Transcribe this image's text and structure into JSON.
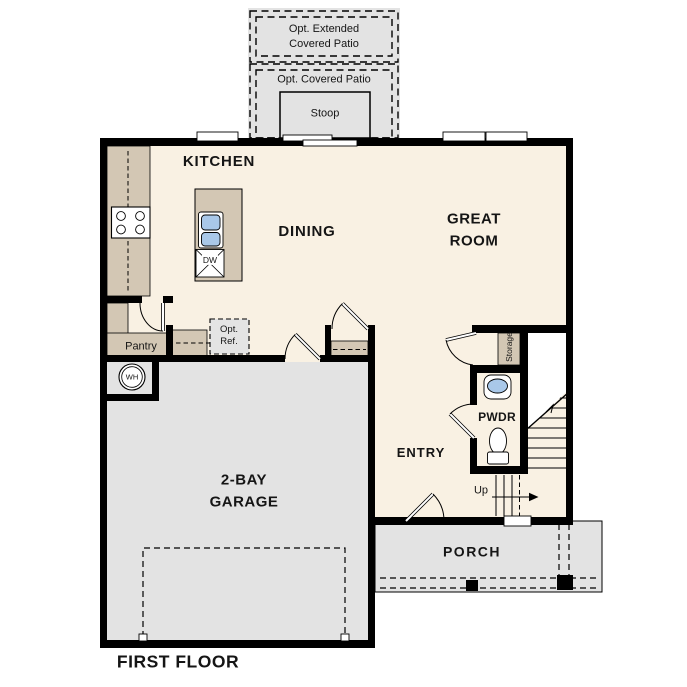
{
  "title": "FIRST FLOOR",
  "rooms": {
    "kitchen": "KITCHEN",
    "dining": "DINING",
    "great_room": "GREAT ROOM",
    "garage": "2-BAY GARAGE",
    "entry": "ENTRY",
    "porch": "PORCH",
    "powder": "PWDR",
    "pantry": "Pantry",
    "storage": "Storage"
  },
  "outdoor": {
    "extended_patio": "Opt. Extended Covered Patio",
    "covered_patio": "Opt. Covered Patio",
    "stoop": "Stoop"
  },
  "annotations": {
    "up": "Up",
    "water_heater": "WH",
    "dishwasher": "DW",
    "opt_ref": "Opt. Ref."
  },
  "colors": {
    "wall": "#000000",
    "floor": "#f9f1e3",
    "garage": "#e3e3e3",
    "counter": "#d3c7b4",
    "sink": "#a9c8e9"
  }
}
